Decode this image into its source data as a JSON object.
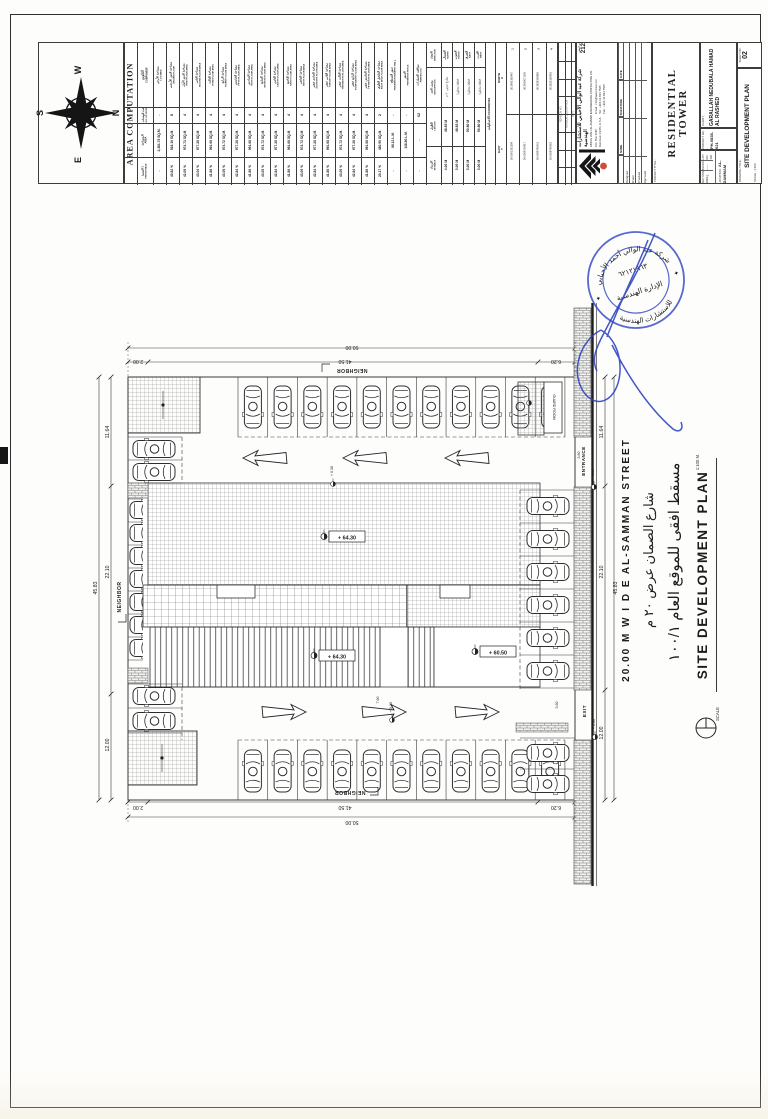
{
  "compass": {
    "n": "N",
    "e": "E",
    "s": "S",
    "w": "W"
  },
  "area_table": {
    "title": "AREA COMPUTATION",
    "headers": {
      "component_ar": "التكوين",
      "component_en": "COMPONENT",
      "units_ar": "عدد الوحدات",
      "units_en": "NO. OF UNITS",
      "area_ar": "المساحة",
      "area_en": "AREA",
      "pct_ar": "النسبة ٪",
      "pct_en": "PERCENTAGE"
    },
    "rows": [
      {
        "ar": "مساحة الأرض",
        "en": "LOT AREA",
        "u": "-",
        "a": "2,381.76 SQ.M.",
        "p": "-"
      },
      {
        "ar": "مساحة الدور الأرضي",
        "en": "GROUND FLOOR",
        "u": "8",
        "a": "918.16 SQ.M.",
        "p": "40.82 %"
      },
      {
        "ar": "مساحة الدور الأول",
        "en": "FIRST FLOOR AREA",
        "u": "4",
        "a": "974.72 SQ.M.",
        "p": "42.05 %"
      },
      {
        "ar": "مساحة الثاني",
        "en": "SECOND FLOOR AREA",
        "u": "4",
        "a": "977.28 SQ.M.",
        "p": "43.04 %"
      },
      {
        "ar": "مساحة الثالث",
        "en": "THIRD FLOOR AREA",
        "u": "4",
        "a": "991.68 SQ.M.",
        "p": "41.86 %"
      },
      {
        "ar": "مساحة الرابع",
        "en": "FOURTH FLOOR AREA",
        "u": "4",
        "a": "974.72 SQ.M.",
        "p": "43.05 %"
      },
      {
        "ar": "مساحة الخامس",
        "en": "FIFTH FLOOR AREA",
        "u": "4",
        "a": "977.28 SQ.M.",
        "p": "42.84 %"
      },
      {
        "ar": "مساحة السادس",
        "en": "SIXTH FLOOR AREA",
        "u": "4",
        "a": "991.68 SQ.M.",
        "p": "41.86 %"
      },
      {
        "ar": "مساحة السابع",
        "en": "SEVENTH FLOOR AREA",
        "u": "4",
        "a": "974.72 SQ.M.",
        "p": "43.05 %"
      },
      {
        "ar": "مساحة الثامن",
        "en": "EIGHTH FLOOR AREA",
        "u": "4",
        "a": "977.28 SQ.M.",
        "p": "42.84 %"
      },
      {
        "ar": "مساحة التاسع",
        "en": "NINTH FLOOR AREA",
        "u": "4",
        "a": "991.68 SQ.M.",
        "p": "41.86 %"
      },
      {
        "ar": "مساحة العاشر",
        "en": "TENTH FLOOR AREA",
        "u": "4",
        "a": "974.72 SQ.M.",
        "p": "43.05 %"
      },
      {
        "ar": "مساحة الحادي عشر",
        "en": "ELEVENTH FLOOR AREA",
        "u": "4",
        "a": "977.28 SQ.M.",
        "p": "42.84 %"
      },
      {
        "ar": "مساحة الثاني عشر",
        "en": "TWELVE FLOOR AREA",
        "u": "4",
        "a": "991.68 SQ.M.",
        "p": "41.86 %"
      },
      {
        "ar": "مساحة الثالث عشر",
        "en": "THIRTEENTH FLOOR AREA",
        "u": "4",
        "a": "974.72 SQ.M.",
        "p": "43.05 %"
      },
      {
        "ar": "مساحة الرابع عشر",
        "en": "FOURTEENTH FLOOR AREA",
        "u": "4",
        "a": "977.28 SQ.M.",
        "p": "42.84 %"
      },
      {
        "ar": "مساحة الخامس عشر",
        "en": "FIFTEENTH FLOOR AREA",
        "u": "4",
        "a": "991.68 SQ.M.",
        "p": "41.86 %"
      },
      {
        "ar": "مساحة الملحق العلوي",
        "en": "ROOF DECK FLOOR AREA",
        "u": "2",
        "a": "480.56 SQ.M.",
        "p": "20.17 %"
      },
      {
        "ar": "سور السطح",
        "en": "PERIMETER PARAPET WALL",
        "u": "-",
        "a": "98.12 L.M.",
        "p": "-"
      },
      {
        "ar": "السور",
        "en": "PERIMETER FENCE",
        "u": "-",
        "a": "148.80 L.M.",
        "p": "-"
      },
      {
        "ar": "مواقف السيارات",
        "en": "PARKING NO.",
        "u": "62",
        "a": "-",
        "p": "-"
      }
    ]
  },
  "boundary_table": {
    "dir_ar": "الاتجاه",
    "dir_en": "DIRECTION",
    "desc_ar": "وصف الحد",
    "desc_en": "DESCRIPTION",
    "len_ar": "الطول",
    "len_en": "LENGTH",
    "set_ar": "الارتداد",
    "set_en": "SETBACK",
    "rows": [
      {
        "ar": "الشمال",
        "en": "NORTH",
        "desc": "شارع عرض ٢٠ م",
        "len": "48.83 M",
        "set": "4.00 M"
      },
      {
        "ar": "الجنوب",
        "en": "SOUTH",
        "desc": "قطعة مجاورة",
        "len": "48.83 M",
        "set": "3.00 M"
      },
      {
        "ar": "الشرق",
        "en": "EAST",
        "desc": "قطعة مجاورة",
        "len": "50.80 M",
        "set": "3.00 M"
      },
      {
        "ar": "الغرب",
        "en": "WEST",
        "desc": "قطعة مجاورة",
        "len": "50.80 M",
        "set": "3.00 M"
      }
    ]
  },
  "coords_table": {
    "title_ar": "الاحداثيات",
    "title_en": "COORDINATES",
    "x_dir": "NORTH",
    "x_axis": "X",
    "y_dir": "EAST",
    "y_axis": "Y",
    "points": [
      {
        "n": "1",
        "x": "26.3692165487",
        "y": "50.0001332299"
      },
      {
        "n": "2",
        "x": "26.3630071105",
        "y": "50.0009750917"
      },
      {
        "n": "3",
        "x": "26.3636136860",
        "y": "50.0099790001"
      },
      {
        "n": "4",
        "x": "26.3625126955",
        "y": "50.0008790081"
      }
    ]
  },
  "title_block": {
    "revision_headers": [
      "REVISION NO.",
      "REVISION DESCRIPTION",
      "DATE"
    ],
    "company": {
      "name_ar": "شركة عبد الوالي الأحبابي للاستشارات الهندسية",
      "name_en": "ABDUL WALI AL-AHBABI ENGINEERING CONSULTING CO.",
      "po_box": "P.O. Box 3195",
      "city": "Dammam 31471, K.S.A.",
      "email": "Email : info@awec-ksa.com",
      "tel": "Tel :  +966 13 834 7565",
      "fax": "Fax : +966 13 834 7565",
      "license_label": "ترخيص",
      "license_no": "212"
    },
    "sign_cols": [
      "Designed",
      "Drawn",
      "Checked",
      "Approved"
    ],
    "sign_heads": [
      "NAME",
      "SIGNATURE",
      "DATE"
    ],
    "project_title_label": "PROJECT TITLE :",
    "project_title": "RESIDENTIAL TOWER",
    "client_label": "CLIENT :",
    "client_line1": "GARALLAH NEDUBALA HAMAD",
    "client_line2": "AL RASHED",
    "project_no_label": "PROJECT NO. :",
    "project_no": "PH-0835-021",
    "section_label": "SECTION",
    "section": "109/ج1",
    "block_label": "BLOCK",
    "block": "——",
    "lot_label": "LOT NO.",
    "lot": "106",
    "location_label": "LOCATION :",
    "location": "AL-DAMMAM",
    "drawing_title_label": "DRAWING TITLE :",
    "drawing_title": "SITE DEVELOPMENT PLAN",
    "scale_label": "SCALE :",
    "scale": "1:100",
    "sheet_label": "SHEET NO.",
    "sheet_no": "02"
  },
  "stamp": {
    "ring_top": "شركة عبد الوالي أحمد الأحبابي",
    "ring_bottom": "للاستشارات الهندسية",
    "inner_number": "٦٢١٢١٩٦٣",
    "inner_line": "الإدارة الهندسية"
  },
  "plan": {
    "street_en": "20.00 M   W I D E   AL-SAMMAN STREET",
    "street_ar": "شارع الصمان عرض ٢٠ م",
    "title_ar": "مسقط افقى للموقع العام  ١٠٠/١",
    "title_en": "SITE DEVELOPMENT PLAN",
    "scale_word": "SCALE",
    "scale_value": "1:100 M.",
    "neighbor": "NEIGHBOR",
    "entrance": "ENTRANCE",
    "exit": "EXIT",
    "guard_room": "GUARD ROOM",
    "levels": {
      "roof": "+ 64.30",
      "canopy": "+ 60.50",
      "zero": "+ 0.00",
      "plinth": "+ 0.30"
    },
    "dims": {
      "total_w": "50.00",
      "total_h": "45.83",
      "top": [
        "2.00",
        "41.50",
        "6.20"
      ],
      "side": [
        "11.64",
        "22.10",
        "12.00"
      ],
      "aisle": "3.60",
      "gap": "7.60"
    }
  }
}
